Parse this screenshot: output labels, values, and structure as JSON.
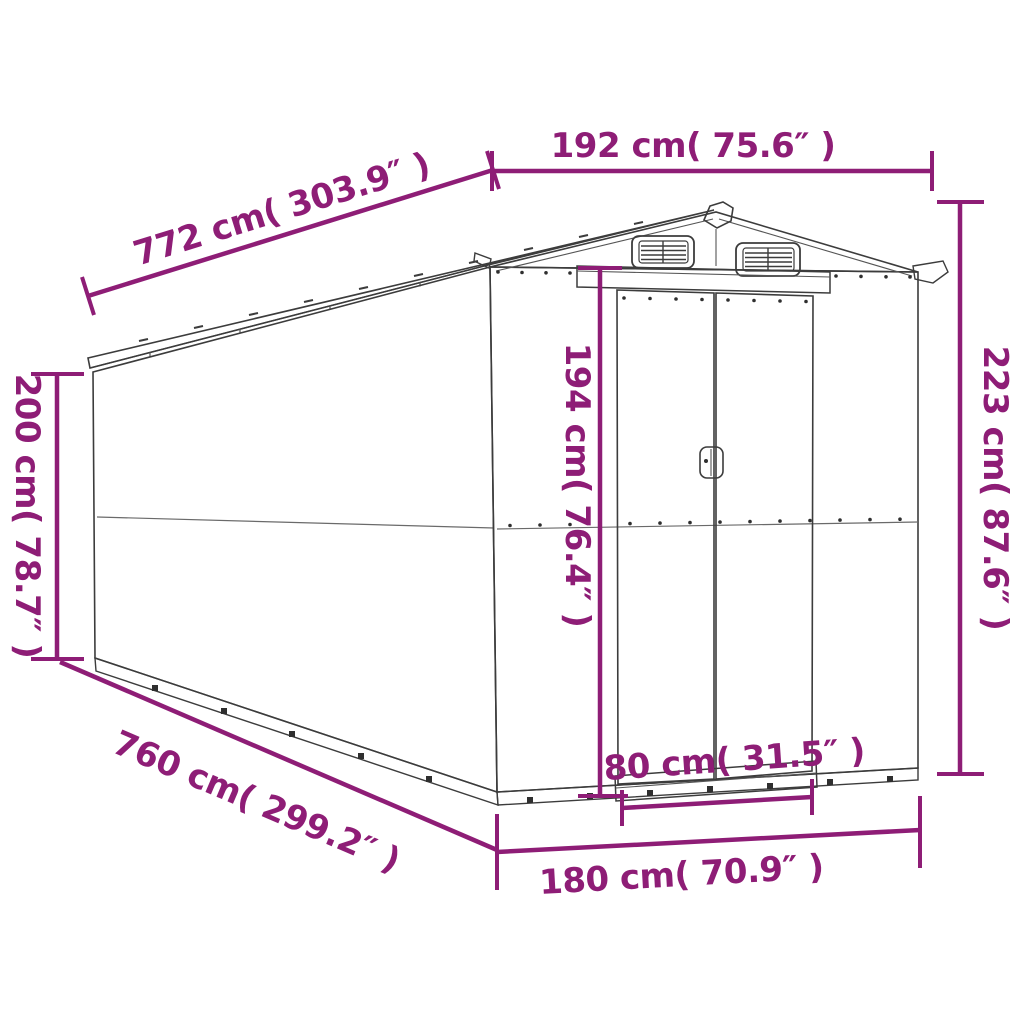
{
  "diagram": {
    "subject": "garden-shed-dimension-drawing",
    "background_color": "#ffffff",
    "accent_color": "#8e1d76",
    "outline_color": "#3c3c3c"
  },
  "dimensions": {
    "front_width_top": "192 cm( 75.6″ )",
    "side_length_top": "772 cm( 303.9″ )",
    "total_height_right": "223 cm( 87.6″ )",
    "wall_height_left": "200 cm( 78.7″ )",
    "door_height": "194 cm( 76.4″ )",
    "door_width": "80 cm( 31.5″ )",
    "front_width_bottom": "180 cm( 70.9″ )",
    "side_length_bottom": "760 cm( 299.2″ )"
  }
}
